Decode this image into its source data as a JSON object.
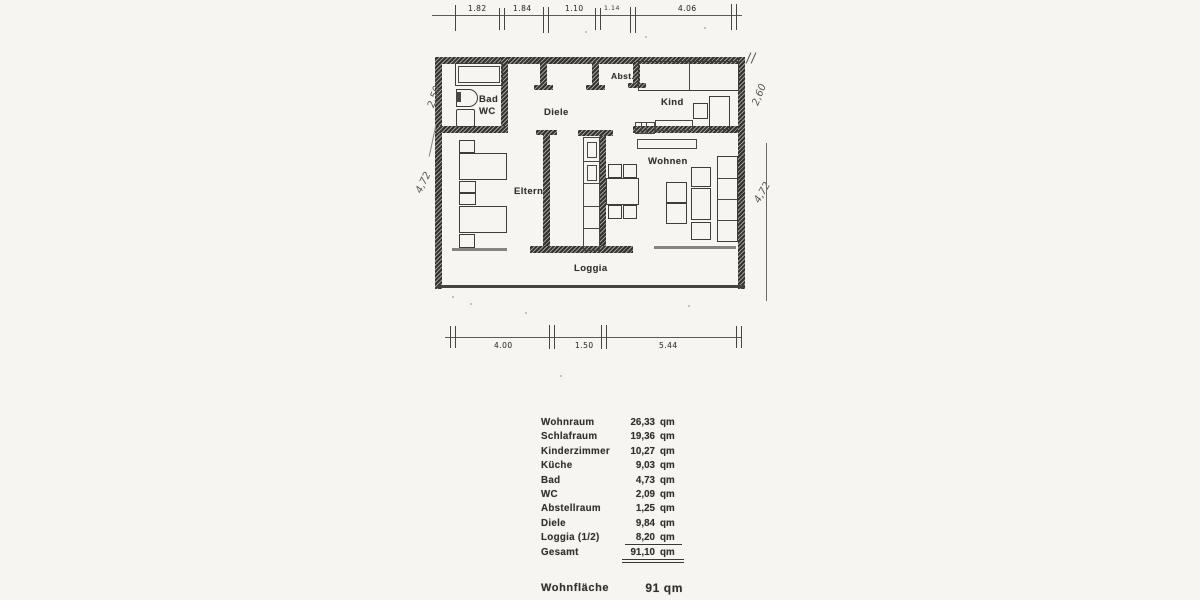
{
  "colors": {
    "paper": "#f6f5f2",
    "ink": "#34312d",
    "wall": "#33312d",
    "window_line": "#87837d"
  },
  "plan": {
    "room_labels": {
      "bad": "Bad",
      "wc": "WC",
      "diele": "Diele",
      "abst": "Abst.",
      "kind": "Kind",
      "eltern": "Eltern",
      "wohnen": "Wohnen",
      "loggia": "Loggia"
    }
  },
  "dimensions": {
    "top": [
      "1.82",
      "1.84",
      "1.10",
      "1.14",
      "4.06"
    ],
    "bottom": [
      "4.00",
      "1.50",
      "5.44"
    ],
    "handwritten": {
      "left_upper": "2,50",
      "left_lower": "4,72",
      "right_upper": "2,60",
      "right_lower": "4,72"
    }
  },
  "area_table": {
    "unit": "qm",
    "rows": [
      {
        "label": "Wohnraum",
        "value": "26,33"
      },
      {
        "label": "Schlafraum",
        "value": "19,36"
      },
      {
        "label": "Kinderzimmer",
        "value": "10,27"
      },
      {
        "label": "Küche",
        "value": "9,03"
      },
      {
        "label": "Bad",
        "value": "4,73"
      },
      {
        "label": "WC",
        "value": "2,09"
      },
      {
        "label": "Abstellraum",
        "value": "1,25"
      },
      {
        "label": "Diele",
        "value": "9,84"
      },
      {
        "label": "Loggia (1/2)",
        "value": "8,20"
      },
      {
        "label": "Gesamt",
        "value": "91,10"
      }
    ],
    "summary": {
      "label": "Wohnfläche",
      "value": "91 qm"
    }
  }
}
